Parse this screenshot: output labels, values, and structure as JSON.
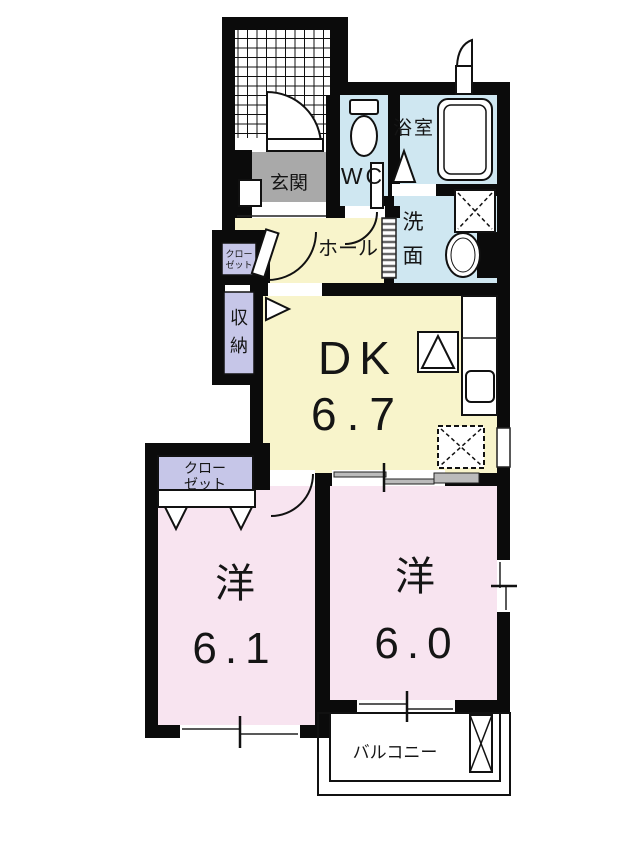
{
  "plan": {
    "colors": {
      "wall": "#0b0b0b",
      "room_yellow": "#f8f4cb",
      "room_blue": "#cfe7f1",
      "room_pink": "#f8e4f0",
      "room_purple": "#c6c6e8",
      "room_gray": "#a9a9a9",
      "background": "#ffffff"
    },
    "rooms": {
      "entrance": {
        "label": "玄関"
      },
      "wc": {
        "label": "WC"
      },
      "bath": {
        "label": "浴室"
      },
      "wash": {
        "char1": "洗",
        "char2": "面"
      },
      "hall": {
        "label": "ホール"
      },
      "hall_closet": {
        "line1": "クロー",
        "line2": "ゼット"
      },
      "storage": {
        "char1": "収",
        "char2": "納"
      },
      "dk": {
        "label": "DK",
        "area": "6.7"
      },
      "bedroom1": {
        "label": "洋",
        "area": "6.1"
      },
      "bedroom1_closet": {
        "line1": "クロー",
        "line2": "ゼット"
      },
      "bedroom2": {
        "label": "洋",
        "area": "6.0"
      },
      "balcony": {
        "label": "バルコニー"
      }
    }
  }
}
